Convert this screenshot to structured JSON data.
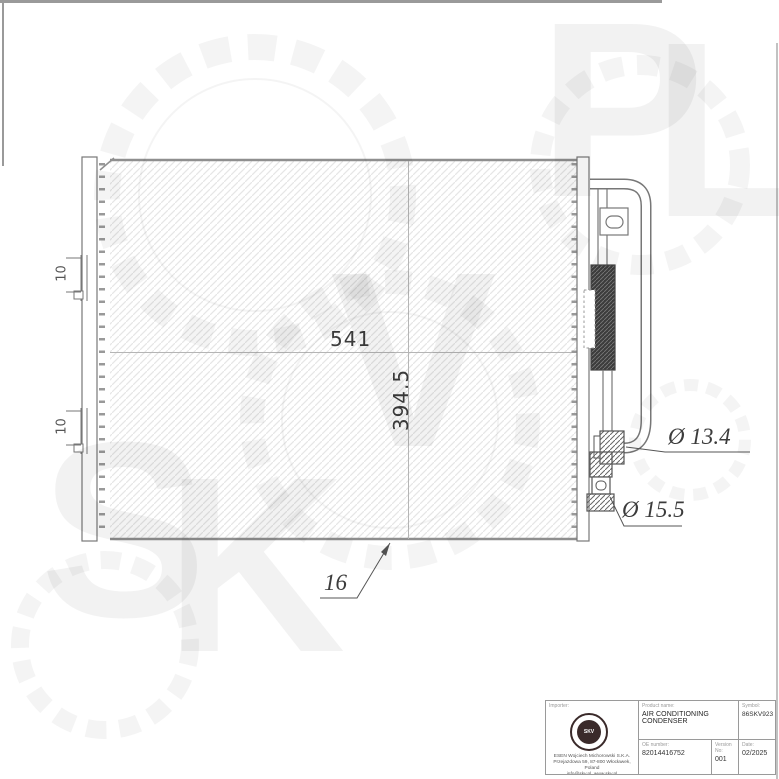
{
  "watermark": {
    "letters": [
      "S",
      "K",
      "V",
      "P",
      "L"
    ]
  },
  "drawing": {
    "dimensions": {
      "core_width": "541",
      "core_height": "394.5",
      "upper_port_diameter": "Ø 13.4",
      "lower_port_diameter": "Ø 15.5",
      "core_depth": "16",
      "bracket_label": "10"
    }
  },
  "title_block": {
    "importer_label": "Importer:",
    "logo_text": "SKV",
    "importer_line1": "ESEN Wojciech Michorowski S.K.A.",
    "importer_line2": "Przejazdowa 59, 87-800 Włocławek, Poland",
    "importer_line3": "info@skv.pl, www.skv.pl",
    "product_name_label": "Product name:",
    "product_name": "AIR CONDITIONING CONDENSER",
    "symbol_label": "Symbol:",
    "symbol": "86SKV923",
    "oe_number_label": "OE number:",
    "oe_number": "82014416752",
    "version_label": "Version No:",
    "version": "001",
    "date_label": "Date:",
    "date": "02/2025"
  }
}
